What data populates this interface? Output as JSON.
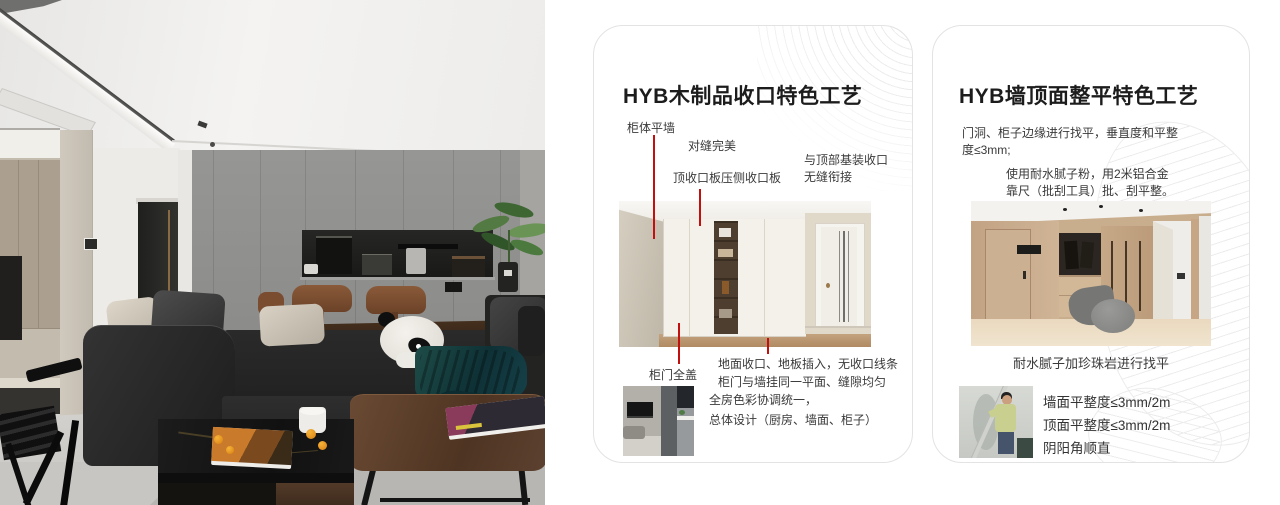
{
  "colors": {
    "accent_red": "#c40f0f",
    "card_border": "#e3e3e3",
    "title_text": "#1c1c1c",
    "body_text": "#3a3a3a"
  },
  "photo": {
    "description": "living-room-photo"
  },
  "cards": [
    {
      "title": "HYB木制品收口特色工艺",
      "annotations": {
        "cabinet_flush_wall": "柜体平墙",
        "perfect_seam": "对缝完美",
        "top_trim_panel": "顶收口板压侧收口板",
        "ceiling_joint_line1": "与顶部基装收口",
        "ceiling_joint_line2": "无缝衔接",
        "door_full_cover": "柜门全盖",
        "floor_joint_line1": "地面收口、地板插入，无收口线条",
        "floor_joint_line2": "柜门与墙挂同一平面、缝隙均匀",
        "summary_line1": "全房色彩协调统一，",
        "summary_line2": "总体设计（厨房、墙面、柜子）"
      }
    },
    {
      "title": "HYB墙顶面整平特色工艺",
      "para1_line1": "门洞、柜子边缘进行找平，垂直度和平整",
      "para1_line2": "度≤3mm;",
      "para2_line1": "使用耐水腻子粉，用2米铝合金",
      "para2_line2": "靠尺（批刮工具）批、刮平整。",
      "caption": "耐水腻子加珍珠岩进行找平",
      "bullet1": "墙面平整度≤3mm/2m",
      "bullet2": "顶面平整度≤3mm/2m",
      "bullet3": "阴阳角顺直"
    }
  ]
}
